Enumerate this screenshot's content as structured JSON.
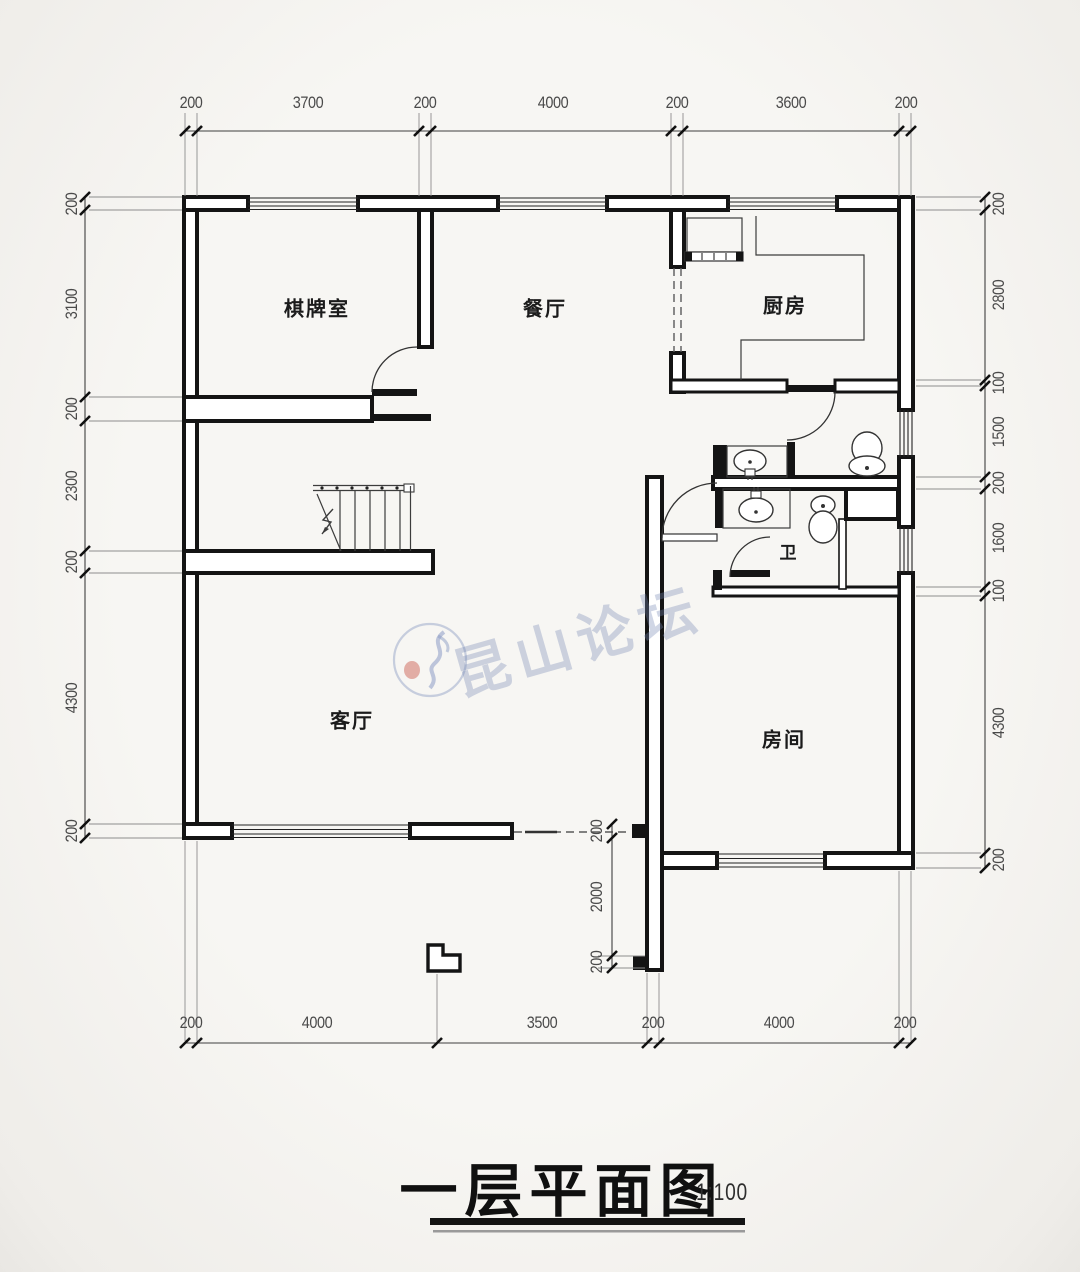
{
  "watermark": {
    "text": "昆山论坛"
  },
  "title": {
    "text": "一层平面图",
    "scale": "1:100"
  },
  "rooms": {
    "chess": "棋牌室",
    "dining": "餐厅",
    "kitchen": "厨房",
    "living": "客厅",
    "bedroom": "房间",
    "bath": "卫"
  },
  "dimensions": {
    "top": [
      "200",
      "3700",
      "200",
      "4000",
      "200",
      "3600",
      "200"
    ],
    "bottom": [
      "200",
      "4000",
      "3500",
      "200",
      "4000",
      "200"
    ],
    "left": [
      "200",
      "3100",
      "200",
      "2300",
      "200",
      "4300",
      "200"
    ],
    "right": [
      "200",
      "2800",
      "100",
      "1500",
      "200",
      "1600",
      "100",
      "4300",
      "200"
    ],
    "entry": [
      "200",
      "2000",
      "200"
    ]
  }
}
